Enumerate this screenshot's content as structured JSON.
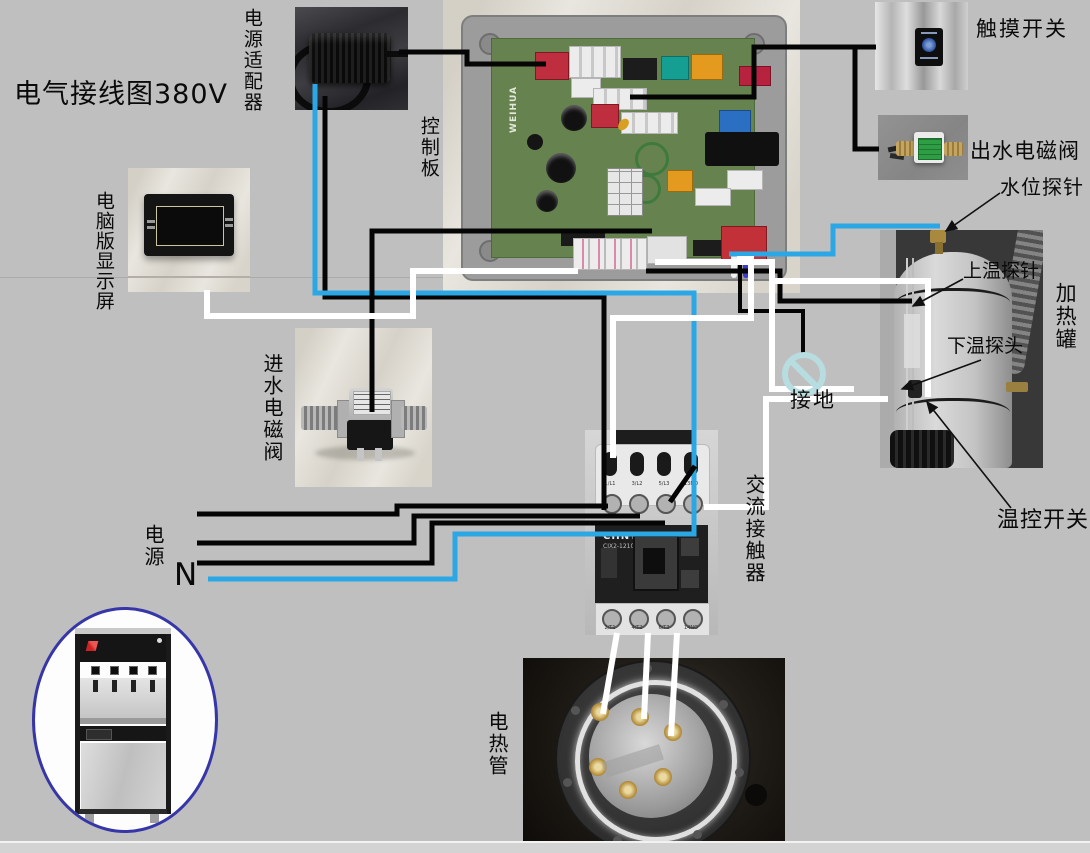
{
  "title": "电气接线图380V",
  "colors": {
    "background": "#bfbfbf",
    "wire_black": "#050505",
    "wire_white": "#ffffff",
    "wire_blue": "#2aa7e4",
    "ground_symbol": "#b7dde1",
    "ellipse_border": "#3636a8"
  },
  "components": {
    "power_adapter": {
      "label": "电源适配器"
    },
    "control_board": {
      "label": "控制板",
      "brand": "WEIHUA"
    },
    "touch_switch": {
      "label": "触摸开关"
    },
    "outlet_valve": {
      "label": "出水电磁阀"
    },
    "water_level_probe": {
      "label": "水位探针"
    },
    "upper_temp_probe": {
      "label": "上温探针"
    },
    "heating_tank": {
      "label": "加热罐"
    },
    "lower_temp_probe": {
      "label": "下温探头"
    },
    "temp_switch": {
      "label": "温控开关"
    },
    "display": {
      "label": "电脑版显示屏"
    },
    "inlet_valve": {
      "label": "进水电磁阀"
    },
    "ground": {
      "label": "接地"
    },
    "contactor": {
      "label": "交流接触器",
      "brand": "CHNT",
      "model": "CJX2-1210",
      "terminals_top": [
        "1/L1",
        "3/L2",
        "5/L3",
        "13NO"
      ],
      "terminals_bottom": [
        "2/T1",
        "4/T2",
        "6/T3",
        "14NO"
      ]
    },
    "power": {
      "label": "电源"
    },
    "neutral": {
      "label": "N"
    },
    "heater_tube": {
      "label": "电热管"
    }
  },
  "wires": [
    {
      "name": "adapter-to-board",
      "color": "black",
      "width": 5,
      "points": [
        [
          399,
          52
        ],
        [
          467,
          52
        ],
        [
          467,
          64
        ],
        [
          546,
          64
        ]
      ]
    },
    {
      "name": "adapter-feed",
      "color": "black",
      "width": 5,
      "points": [
        [
          325,
          96
        ],
        [
          325,
          297
        ],
        [
          604,
          297
        ],
        [
          604,
          510
        ]
      ]
    },
    {
      "name": "neutral-blue",
      "color": "blue",
      "width": 5,
      "points": [
        [
          208,
          579
        ],
        [
          455,
          579
        ],
        [
          455,
          534
        ],
        [
          694,
          534
        ],
        [
          694,
          293
        ],
        [
          315,
          293
        ],
        [
          315,
          84
        ]
      ]
    },
    {
      "name": "board-to-inlet-valve",
      "color": "black",
      "width": 5,
      "points": [
        [
          652,
          231
        ],
        [
          372,
          231
        ],
        [
          372,
          412
        ]
      ]
    },
    {
      "name": "board-to-touch-switch",
      "color": "black",
      "width": 5,
      "points": [
        [
          630,
          97
        ],
        [
          754,
          97
        ],
        [
          754,
          47
        ],
        [
          876,
          47
        ]
      ]
    },
    {
      "name": "branch-to-outlet-valve",
      "color": "black",
      "width": 5,
      "points": [
        [
          855,
          47
        ],
        [
          855,
          149
        ],
        [
          879,
          149
        ]
      ]
    },
    {
      "name": "board-to-upper-probe",
      "color": "black",
      "width": 5,
      "points": [
        [
          646,
          271
        ],
        [
          780,
          271
        ],
        [
          780,
          301
        ],
        [
          912,
          301
        ]
      ]
    },
    {
      "name": "board-to-ground",
      "color": "black",
      "width": 4,
      "points": [
        [
          740,
          255
        ],
        [
          740,
          311
        ],
        [
          803,
          311
        ],
        [
          803,
          355
        ]
      ]
    },
    {
      "name": "contactor-no-jumper",
      "color": "black",
      "width": 5,
      "points": [
        [
          670,
          502
        ],
        [
          695,
          466
        ]
      ]
    },
    {
      "name": "power-line-1",
      "color": "black",
      "width": 5,
      "points": [
        [
          197,
          514
        ],
        [
          397,
          514
        ],
        [
          397,
          506
        ],
        [
          608,
          506
        ]
      ]
    },
    {
      "name": "power-line-2",
      "color": "black",
      "width": 5,
      "points": [
        [
          197,
          543
        ],
        [
          414,
          543
        ],
        [
          414,
          516
        ],
        [
          640,
          516
        ]
      ]
    },
    {
      "name": "power-line-3",
      "color": "black",
      "width": 5,
      "points": [
        [
          197,
          563
        ],
        [
          432,
          563
        ],
        [
          432,
          523
        ],
        [
          665,
          523
        ]
      ]
    },
    {
      "name": "board-to-water-level-probe",
      "color": "blue",
      "width": 5,
      "points": [
        [
          729,
          254
        ],
        [
          833,
          254
        ],
        [
          833,
          226
        ],
        [
          940,
          226
        ]
      ]
    },
    {
      "name": "display-to-board",
      "color": "white",
      "width": 6,
      "points": [
        [
          207,
          290
        ],
        [
          207,
          316
        ],
        [
          413,
          316
        ],
        [
          413,
          271
        ],
        [
          578,
          271
        ]
      ]
    },
    {
      "name": "board-to-lower-probe",
      "color": "white",
      "width": 6,
      "points": [
        [
          655,
          262
        ],
        [
          772,
          262
        ],
        [
          772,
          389
        ],
        [
          854,
          389
        ]
      ]
    },
    {
      "name": "tank-white",
      "color": "white",
      "width": 6,
      "points": [
        [
          772,
          281
        ],
        [
          928,
          281
        ],
        [
          928,
          397
        ]
      ]
    },
    {
      "name": "contactor-to-tank",
      "color": "white",
      "width": 6,
      "points": [
        [
          704,
          507
        ],
        [
          766,
          507
        ],
        [
          766,
          399
        ],
        [
          888,
          399
        ]
      ]
    },
    {
      "name": "board-to-contactor-coil",
      "color": "white",
      "width": 6,
      "points": [
        [
          737,
          259
        ],
        [
          751,
          259
        ],
        [
          751,
          318
        ],
        [
          613,
          318
        ],
        [
          613,
          458
        ]
      ]
    },
    {
      "name": "heater-wire-1",
      "color": "white",
      "width": 6,
      "points": [
        [
          617,
          633
        ],
        [
          603,
          714
        ]
      ]
    },
    {
      "name": "heater-wire-2",
      "color": "white",
      "width": 6,
      "points": [
        [
          648,
          633
        ],
        [
          644,
          719
        ]
      ]
    },
    {
      "name": "heater-wire-3",
      "color": "white",
      "width": 6,
      "points": [
        [
          677,
          633
        ],
        [
          671,
          736
        ]
      ]
    }
  ],
  "arrows": [
    {
      "name": "water-level-probe-arrow",
      "points": [
        [
          1000,
          193
        ],
        [
          946,
          231
        ]
      ]
    },
    {
      "name": "upper-temp-probe-arrow",
      "points": [
        [
          963,
          279
        ],
        [
          913,
          306
        ]
      ]
    },
    {
      "name": "lower-temp-probe-arrow",
      "points": [
        [
          981,
          360
        ],
        [
          902,
          389
        ]
      ]
    },
    {
      "name": "temp-switch-arrow",
      "points": [
        [
          1011,
          508
        ],
        [
          927,
          402
        ]
      ]
    }
  ]
}
